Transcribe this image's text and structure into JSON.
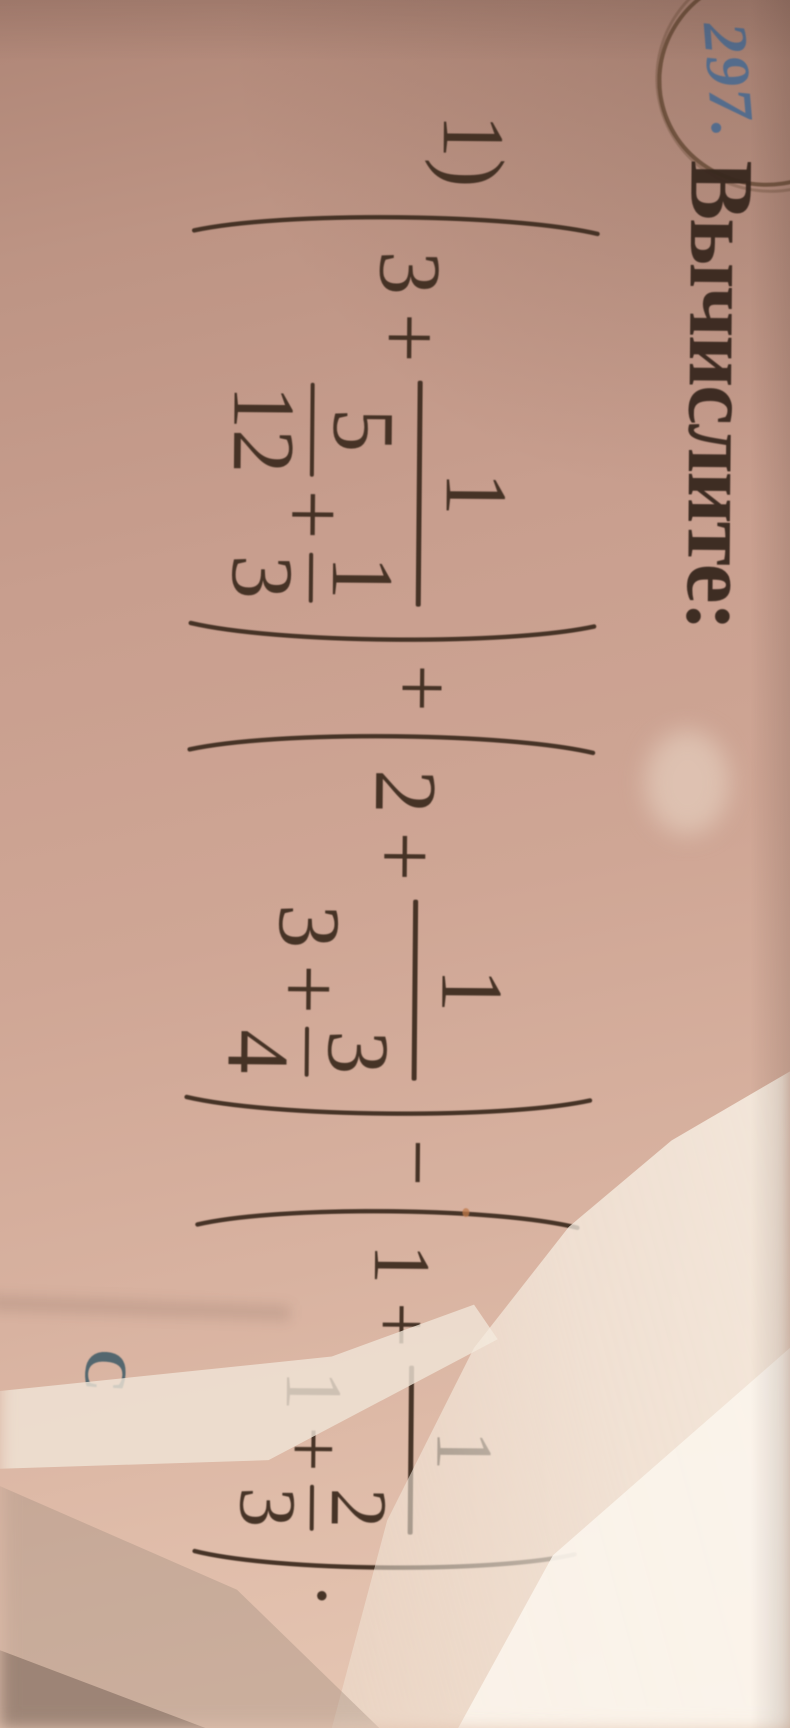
{
  "photo_page": {
    "problem_number": "297.",
    "heading": "Вычислите:",
    "exercise": {
      "label": "1)",
      "terms": [
        {
          "whole": "3",
          "operator": "+",
          "fraction": {
            "numerator": "1",
            "denominator": {
              "fraction_1": {
                "numerator": "5",
                "denominator": "12"
              },
              "operator": "+",
              "fraction_2": {
                "numerator": "1",
                "denominator": "3"
              }
            }
          }
        },
        {
          "whole": "2",
          "operator": "+",
          "fraction": {
            "numerator": "1",
            "denominator": {
              "integer": "3",
              "operator": "+",
              "fraction_2": {
                "numerator": "3",
                "denominator": "4"
              }
            }
          }
        },
        {
          "whole": "1",
          "operator": "+",
          "fraction": {
            "numerator": "1",
            "denominator": {
              "integer": "1",
              "operator": "+",
              "fraction_2": {
                "numerator": "2",
                "denominator": "3"
              }
            }
          }
        }
      ],
      "operator_between_terms_1_2": "+",
      "operator_between_terms_2_3": "−",
      "terminator": ".",
      "expression_linear": "(3 + 1/(5/12 + 1/3)) + (2 + 1/(3 + 3/4)) − (1 + 1/(1 + 2/3))."
    },
    "margin_letter": "C",
    "colors": {
      "ink": "#3e2c20",
      "pen_circle_brown": "#5c422c",
      "problem_number_blue": "#4b6a8e",
      "margin_letter_teal": "#3d5a66",
      "page_tone": "#cfa695",
      "highlight_white": "#faf3e8"
    }
  }
}
